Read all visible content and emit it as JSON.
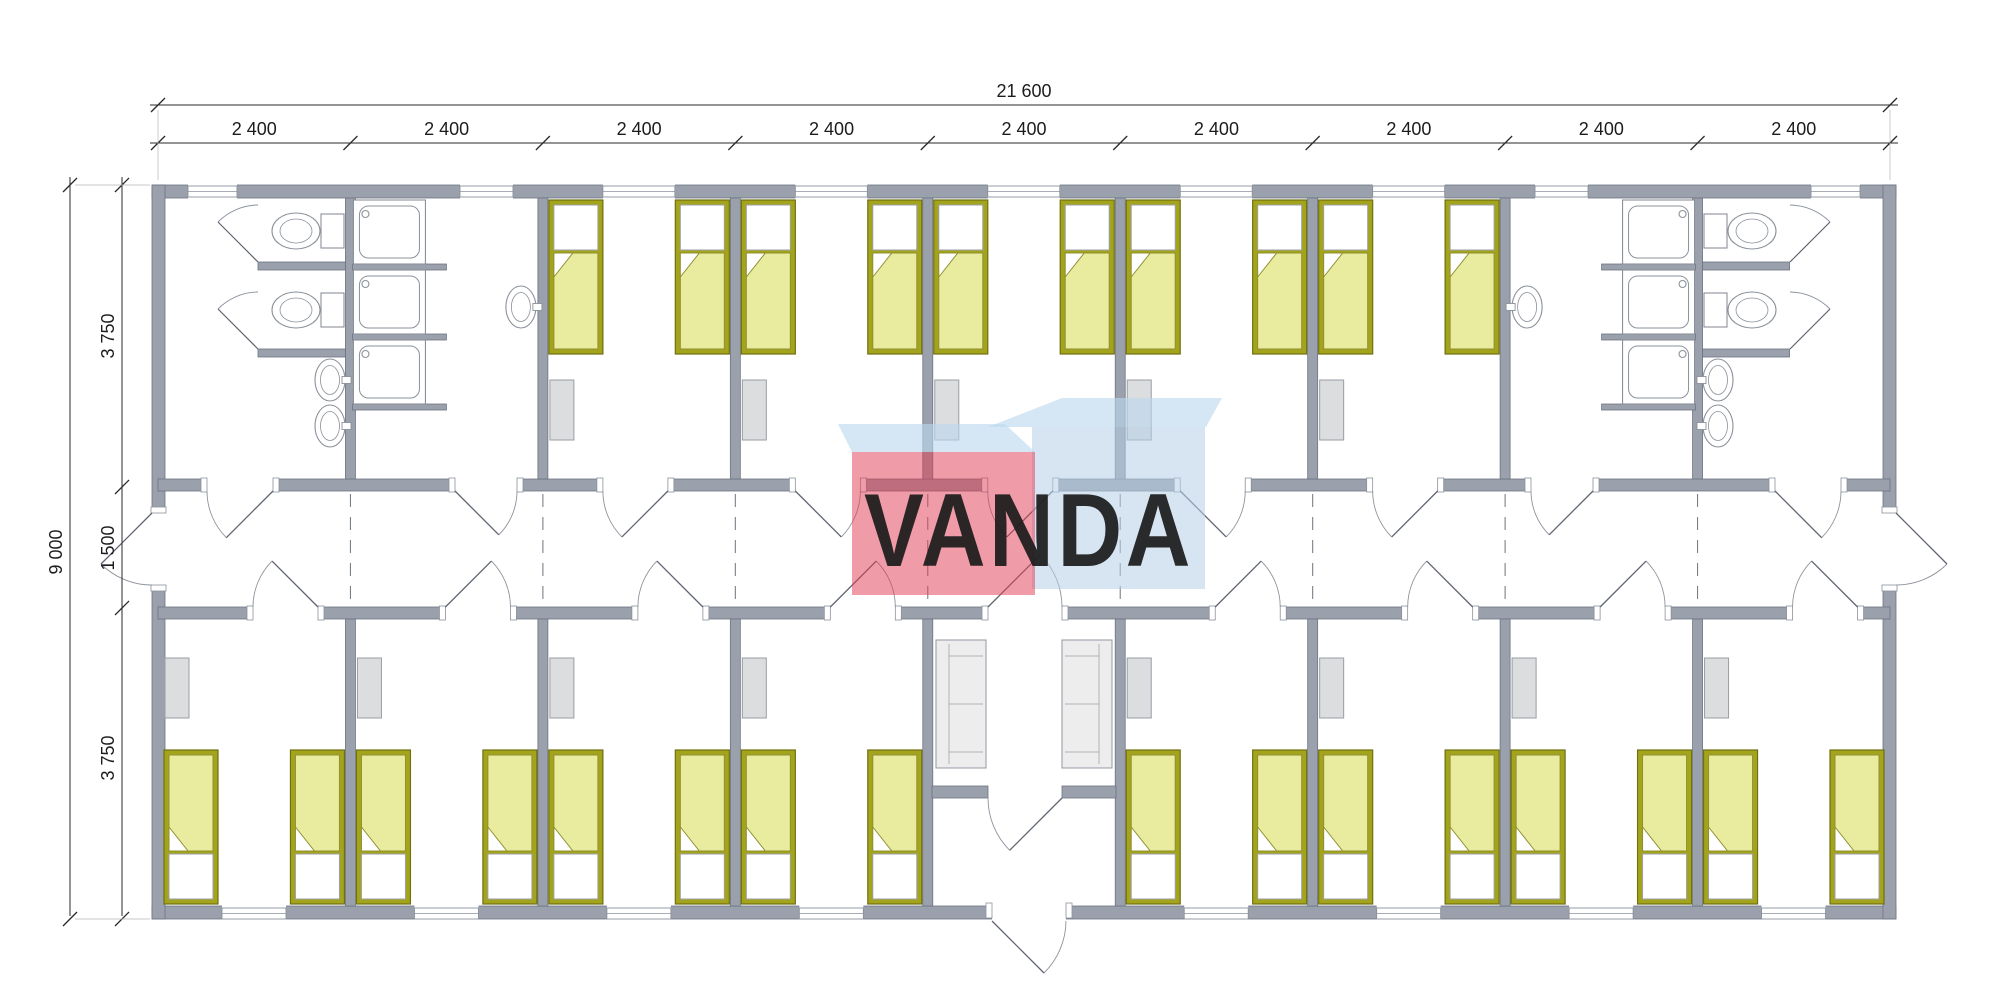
{
  "watermark": {
    "text": "VANDA",
    "red_face": "#e23a52",
    "blue_face": "#b7cfe7",
    "light_top_face": "#bcd9ee",
    "text_color": "#ffffff"
  },
  "dimensions": {
    "overall_width": "21 600",
    "module_width": "2 400",
    "module_count": 9,
    "overall_depth": "9 000",
    "upper_rooms_depth": "3 750",
    "corridor_depth": "1 500",
    "lower_rooms_depth": "3 750"
  },
  "inventory": {
    "single_beds": 26,
    "bedrooms": 13,
    "wc_rooms": 2,
    "shower_rooms": 2,
    "toilets": 4,
    "showers": 6,
    "wash_basins": 6,
    "sofas": 2,
    "wardrobes": 13,
    "exterior_doors": 3
  },
  "rooms": {
    "top_row": [
      "wc-room",
      "shower-room",
      "bedroom",
      "bedroom",
      "bedroom",
      "bedroom",
      "bedroom",
      "shower-room",
      "wc-room"
    ],
    "bottom_row": [
      "bedroom",
      "bedroom",
      "bedroom",
      "bedroom",
      "entrance-lobby",
      "bedroom",
      "bedroom",
      "bedroom",
      "bedroom"
    ],
    "corridor": "central corridor with exit doors at both ends"
  },
  "colors": {
    "wall": "#9aa1ad",
    "wall_edge": "#6d7480",
    "bed_frame": "#a4a41c",
    "bed_blanket": "#e9eb9e",
    "furniture_gray": "#dcdddf",
    "fixture_line": "#8b919b"
  }
}
